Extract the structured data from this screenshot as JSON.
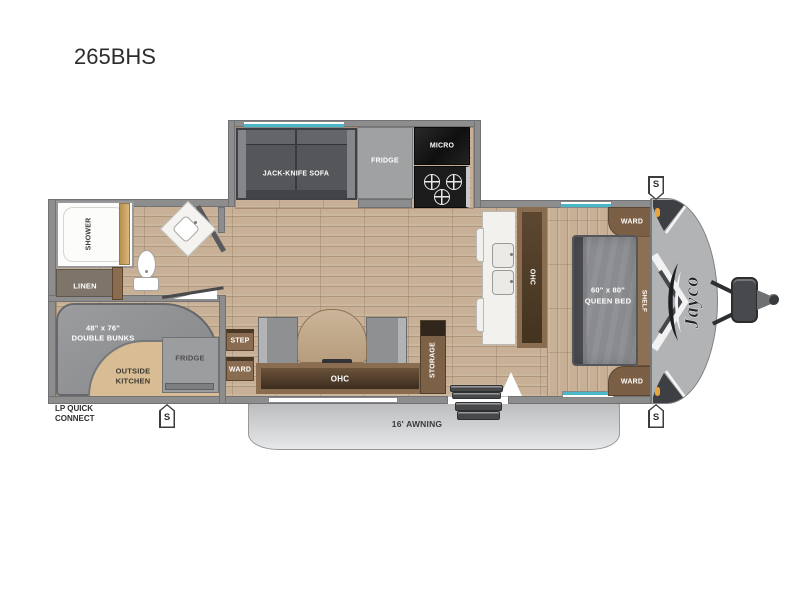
{
  "title": "265BHS",
  "colors": {
    "floor_wood": "#c7b096",
    "wall_gray": "#8d8d8e",
    "cabinet_brown": "#8a6d50",
    "cushion_gray": "#8f9092",
    "outside_kitchen_tan": "#d8bd94",
    "window_accent_teal": "#4ab7c9",
    "clearance_light_orange": "#e9a43c",
    "front_cap_gray": "#b2b3b5",
    "appliance_black": "#161617"
  },
  "slideout": {
    "sofa": "JACK-KNIFE SOFA",
    "fridge": "FRIDGE",
    "micro": "MICRO"
  },
  "bath": {
    "shower": "SHOWER",
    "linen": "LINEN"
  },
  "bunkroom": {
    "size": "48\" x 76\"",
    "name": "DOUBLE BUNKS",
    "outside_kitchen_1": "OUTSIDE",
    "outside_kitchen_2": "KITCHEN",
    "fridge": "FRIDGE"
  },
  "hall": {
    "step": "STEP",
    "ward": "WARD"
  },
  "dinette": {
    "ohc": "OHC",
    "storage": "STORAGE"
  },
  "kitchen": {
    "ohc": "OHC"
  },
  "bedroom": {
    "size": "60\" x 80\"",
    "name": "QUEEN BED",
    "shelf": "SHELF",
    "ward_top": "WARD",
    "ward_bottom": "WARD"
  },
  "exterior": {
    "awning": "16' AWNING",
    "lp_1": "LP QUICK",
    "lp_2": "CONNECT",
    "speaker": "S",
    "brand": "Jayco"
  }
}
